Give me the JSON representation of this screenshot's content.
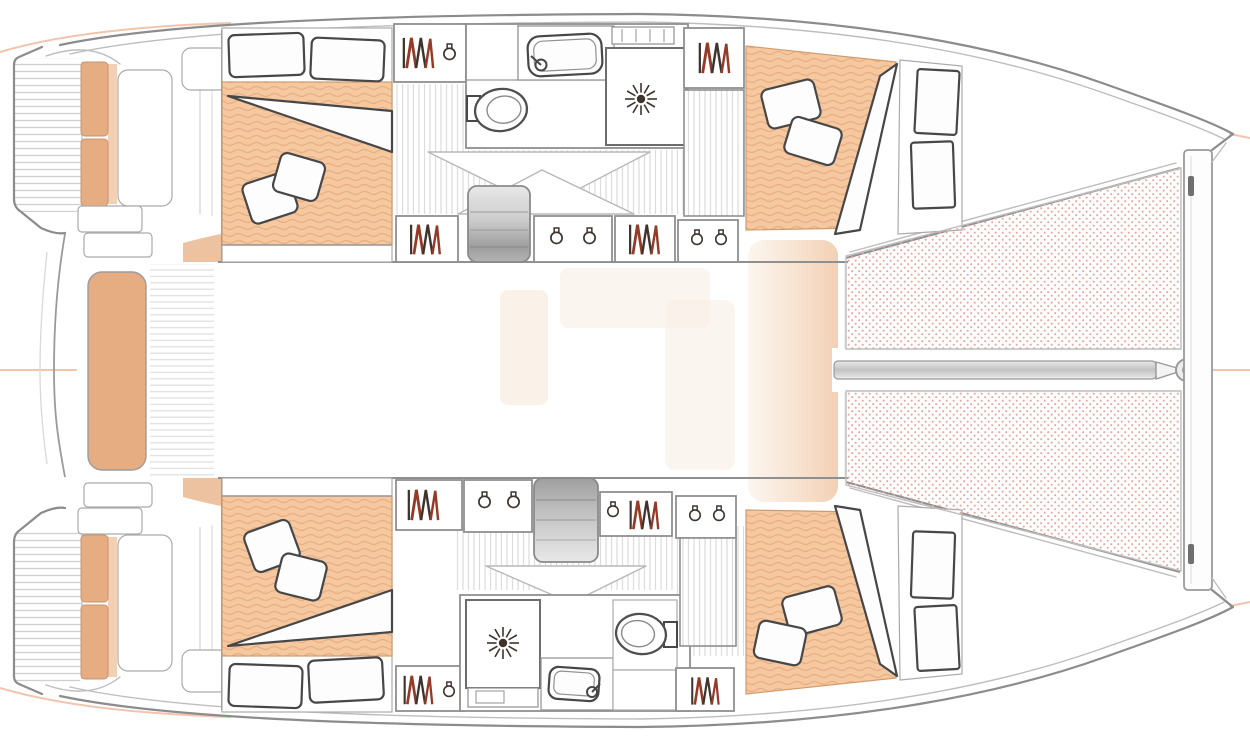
{
  "page": {
    "title": "Catamaran interior layout plan",
    "background": "#ffffff"
  },
  "diagram": {
    "type": "boat-floor-plan",
    "vessel": "sailing catamaran, 4-cabin / 2-head layout",
    "orientation": {
      "bow": "right",
      "stern": "left",
      "upper": "port hull",
      "lower": "starboard hull"
    },
    "counts": {
      "hulls": 2,
      "cabins": 4,
      "bathrooms": 2,
      "trampoline_nets": 2,
      "swim_platforms": 2
    },
    "rooms": [
      {
        "id": "port-aft-cabin",
        "label": "aft cabin (upper hull, left)",
        "furniture": [
          "double berth",
          "two pillows",
          "folded blanket",
          "headboard cushions",
          "foot board"
        ]
      },
      {
        "id": "port-head",
        "label": "bathroom (upper hull, middle)",
        "furniture": [
          "washbasin with faucet",
          "toilet",
          "shower stall with shower head",
          "vent grate"
        ]
      },
      {
        "id": "port-forward-cabin",
        "label": "forward cabin (upper hull, right)",
        "furniture": [
          "double berth",
          "two pillows",
          "folded blanket",
          "side shelf with cushions",
          "wardrobe",
          "slatted dresser"
        ]
      },
      {
        "id": "starboard-aft-cabin",
        "label": "aft cabin (lower hull, left)",
        "furniture": [
          "double berth",
          "two pillows",
          "folded blanket",
          "foot cushions"
        ]
      },
      {
        "id": "starboard-head",
        "label": "bathroom (lower hull, middle)",
        "furniture": [
          "washbasin with faucet",
          "toilet",
          "shower stall with shower head",
          "towel locker"
        ]
      },
      {
        "id": "starboard-forward-cabin",
        "label": "forward cabin (lower hull, right)",
        "furniture": [
          "double berth",
          "two pillows",
          "folded blanket",
          "side shelf with cushions",
          "wardrobe",
          "slatted dresser"
        ]
      },
      {
        "id": "saloon",
        "label": "bridgedeck saloon (washed-out center)",
        "furniture": [
          "peach lounge pad"
        ]
      },
      {
        "id": "aft-cockpit",
        "label": "aft cockpit between hulls",
        "furniture": [
          "bench seat",
          "planked deck",
          "corner seats",
          "transom steps"
        ]
      },
      {
        "id": "swim-platforms",
        "label": "stern swim platforms with steps",
        "furniture": [
          "transom seat cushions",
          "helm seats"
        ]
      },
      {
        "id": "foredeck",
        "label": "bow area",
        "furniture": [
          "two trampoline nets",
          "bowsprit with ring fitting",
          "forward crossbeam"
        ]
      }
    ],
    "icons": [
      {
        "name": "wardrobe-hanging-clothes-icon",
        "glyph": "zigzag strokes (rust + dark)"
      },
      {
        "name": "storage-jar-icon",
        "glyph": "small circle with neck"
      },
      {
        "name": "shower-head-icon",
        "glyph": "12-ray star with center dot"
      },
      {
        "name": "faucet-icon",
        "glyph": "circle with spout line"
      },
      {
        "name": "toilet-icon",
        "glyph": "double ellipse with cistern"
      },
      {
        "name": "companionway-steps-icon",
        "glyph": "grey gradient treads"
      }
    ]
  },
  "palette": {
    "outline": "#8c8c8c",
    "outline-soft": "#bdbdbd",
    "wall": "#8f8f8f",
    "furn": "#474747",
    "mattress": "#f5c8a0",
    "mattress-line": "#e9ae82",
    "mattress-edge": "#cf9b6e",
    "cushion": "#e6ac82",
    "cushion-light": "#f3cfb3",
    "saloon-pad": "#f7e3d1",
    "saloon-pad-deep": "#f3d0b4",
    "net-dot": "#e7a89c",
    "floor-line": "#dcdcdc",
    "plank": "#cfcfcf",
    "deck-line": "#dedede",
    "step-dark": "#9a9a9a",
    "step-light": "#e6e6e6",
    "rust": "#943a27",
    "ink": "#3e332d",
    "faint": "#f3c4ad",
    "ghost": "#faf1e8",
    "bg": "#ffffff"
  }
}
